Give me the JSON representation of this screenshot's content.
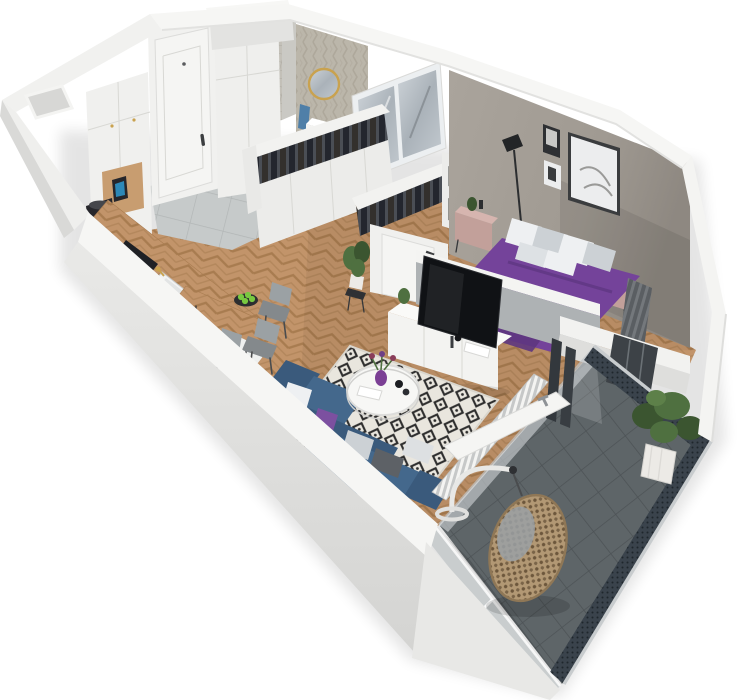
{
  "scene": {
    "kind": "isometric-3d-apartment-floorplan-render",
    "rooms": {
      "kitchen": {
        "name": "kitchen",
        "items": [
          "tall-cabinets",
          "wood-counter",
          "cooktop",
          "sink",
          "gold-faucet",
          "kettle",
          "coffee-machine"
        ]
      },
      "hallway": {
        "name": "hallway",
        "items": [
          "entrance-door",
          "hall-closet",
          "gray-tile-floor"
        ]
      },
      "bathroom": {
        "name": "bathroom",
        "items": [
          "herringbone-tile-walls",
          "tiled-duct",
          "round-gold-mirror",
          "vanity-sink",
          "toilet",
          "washing-machine",
          "blue-towel"
        ]
      },
      "closet": {
        "name": "walk-in-closet",
        "items": [
          "clothes-rack-front",
          "clothes-rack-back",
          "storage-boxes",
          "mirrored-wardrobe",
          "bedroom-door",
          "potted-plant"
        ]
      },
      "bedroom": {
        "name": "bedroom",
        "items": [
          "double-bed",
          "pillows",
          "nightstand-left",
          "nightstand-right",
          "floor-lamp",
          "wall-art-large",
          "wall-art-small",
          "radiator",
          "taupe-accent-wall",
          "balcony-window"
        ]
      },
      "living": {
        "name": "living-room",
        "items": [
          "corner-sofa",
          "throw-pillows",
          "diamond-rug",
          "round-coffee-table",
          "flower-vase",
          "tv",
          "tv-console",
          "knee-wall",
          "slat-radiator",
          "open-balcony-door"
        ]
      },
      "dining": {
        "name": "dining-area",
        "items": [
          "wood-table",
          "chairs",
          "apple-bowl"
        ]
      },
      "balcony": {
        "name": "balcony",
        "items": [
          "dark-tile-floor",
          "perforated-railing",
          "glass-screen",
          "hanging-egg-chair",
          "potted-tree"
        ]
      }
    },
    "floors": {
      "main": "herringbone-oak",
      "hall": "light-gray-tile",
      "balcony": "dark-gray-tile"
    }
  },
  "colors": {
    "wallTop": "#f6f6f4",
    "wallFace": "#e7e7e5",
    "wallOuterFace": "#d9d9d7",
    "wallInner": "#efefed",
    "wallShade": "#cfcfcd",
    "accentWall": "#a49e96",
    "kneeWallFace": "#aeb2b4",
    "woodBase": "#c2946a",
    "hallTileBase": "#c6caca",
    "balconyTileBase": "#5e6568",
    "bathTileBase": "#cfc9bd",
    "ductTile": "#bdbab2",
    "bedPurple": "#74439a",
    "bedPurpleDark": "#5e3680",
    "pillowWhite": "#eef0f2",
    "pillowGray": "#ccd1d5",
    "pillowDark": "#5d6166",
    "pillowPurple": "#7c50a0",
    "nightPink": "#c2a09a",
    "nightPinkTop": "#d6b5af",
    "sofaBlue": "#44688c",
    "sofaBlueDark": "#3a5a7c",
    "rugBase": "#e9e6de",
    "rugInk": "#2e2e2e",
    "tvBlack": "#101215",
    "consoleWhite": "#f3f3f1",
    "doorWhite": "#f5f5f3",
    "closetWhite": "#ececea",
    "boxGray": "#9b9b97",
    "railDark": "#3a434c",
    "railLight": "#c8ccce",
    "glassPane": "#c0c5c7",
    "mirrorBlue": "#b9c0c6",
    "rattan": "#b29874",
    "rattanDark": "#6d573c",
    "plantGreen": "#4f7040",
    "plantDeep": "#3b5530",
    "potWhite": "#eceae6",
    "gold": "#c9a24f",
    "chairGray": "#9ba1a4",
    "chairGrayDark": "#84898c",
    "appleGreen": "#79c940",
    "vasePurple": "#7b3f94",
    "towelBlue": "#4f7fa8",
    "applianceBlack": "#26262b",
    "cooktopBlack": "#1f2125",
    "radGray": "#6a6e72",
    "sinkWhite": "#f2f3f3",
    "fixtureWhite": "#f4f4f2",
    "artInk": "#2e3033",
    "artMat": "#ecedee",
    "kettleBlue": "#2f9ad0",
    "shadow": "#000000"
  }
}
